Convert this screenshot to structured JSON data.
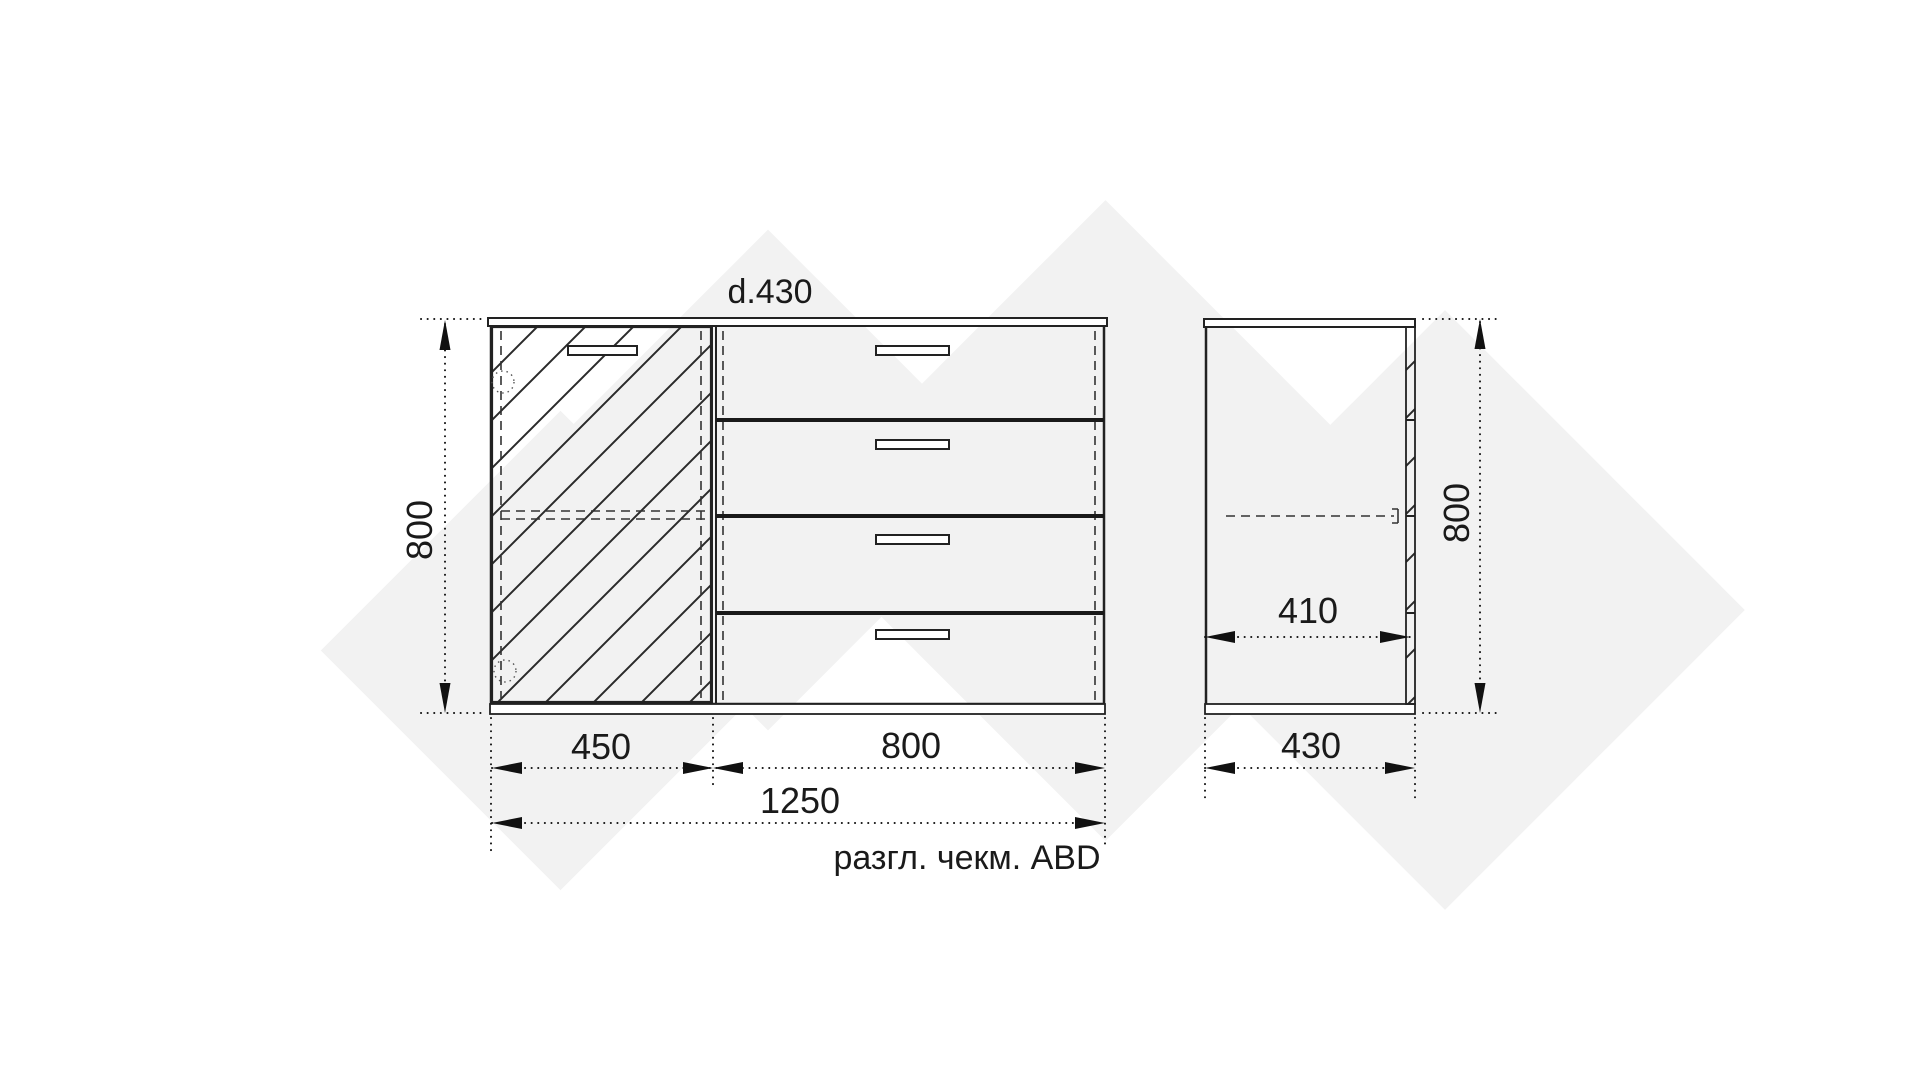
{
  "page": {
    "background": "#ffffff",
    "type": "furniture technical drawing"
  },
  "colors": {
    "line": "#222222",
    "dimension": "#111111",
    "text": "#1a1a1a",
    "watermark": "#f2f2f2",
    "fill": "#ffffff"
  },
  "drawing": {
    "top_depth_label": "d.430",
    "caption": "разгл. чекм. ABD",
    "front_view": {
      "label": "front-view",
      "height_dim": "800",
      "door_width_dim": "450",
      "drawer_width_dim": "800",
      "overall_width_dim": "1250",
      "drawer_count": 4,
      "door_style": "hatched with diagonal lines, dashed edge lines, dotted hinge circles",
      "handles": "slim rectangular slots, one per drawer and one on door"
    },
    "side_view": {
      "label": "side-view",
      "height_dim": "800",
      "inner_depth_dim": "410",
      "overall_depth_dim": "430",
      "shelf": "dashed line at mid height"
    }
  }
}
